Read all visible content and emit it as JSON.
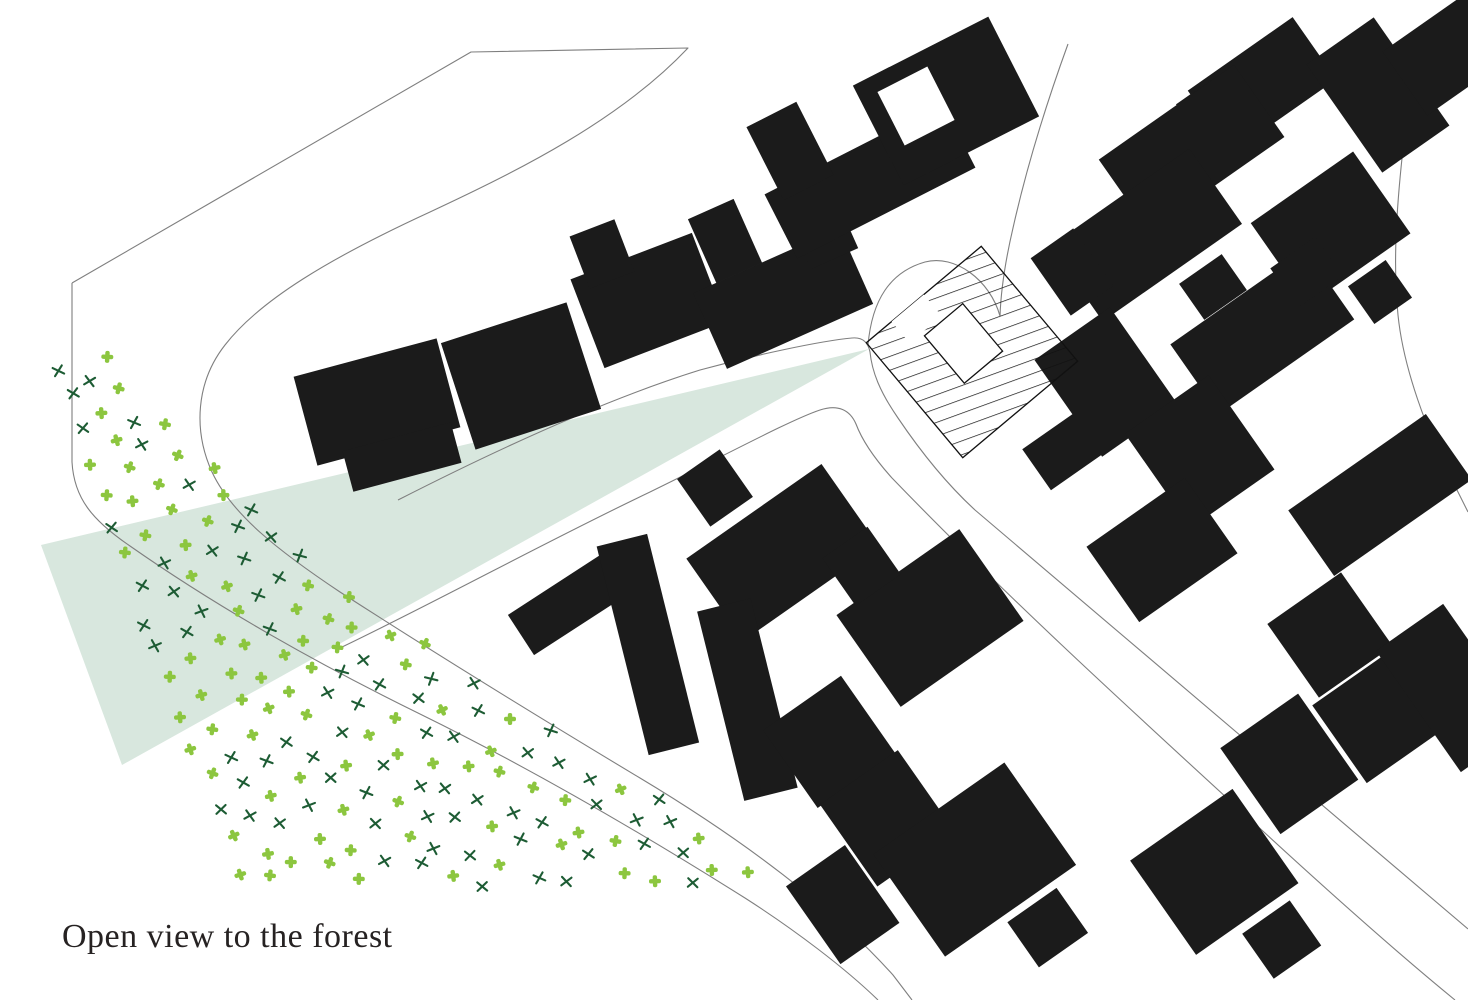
{
  "caption": {
    "text": "Open view to the forest"
  },
  "colors": {
    "background": "#ffffff",
    "building": "#1b1b1b",
    "street_line": "#7f7f7f",
    "view_cone": "#d8e7de",
    "forest_light": "#8cc63f",
    "forest_dark": "#1d5c34",
    "site_outline": "#111111",
    "site_fill": "#ffffff",
    "caption_text": "#262222"
  },
  "map": {
    "type": "architectural-site-plan",
    "site_marker": "hatched-building-with-courtyard",
    "view_cone_note": "view cone from site building toward forest",
    "forest_note": "forest indicated by scattered tree symbols"
  }
}
